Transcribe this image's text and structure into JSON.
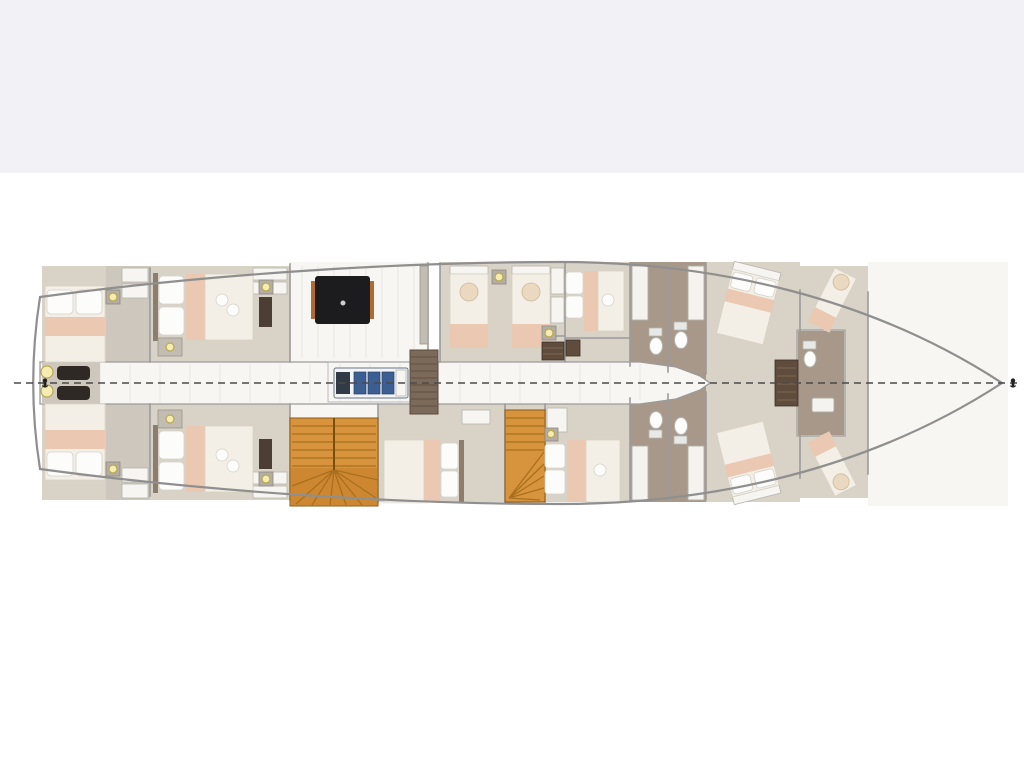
{
  "meta": {
    "title": "Yacht lower deck floor plan",
    "view": "top-down deck plan",
    "bow_direction": "right",
    "visible_text": "none"
  },
  "colors": {
    "page_background": "#ffffff",
    "top_band": "#f1f1f6",
    "hull_outline": "#8f8f8f",
    "wall": "#9b9b9b",
    "cabin_floor": "#d9d2c6",
    "bathroom_floor": "#a79889",
    "corridor_floor": "#f7f6f2",
    "bed_duvet": "#f3efe6",
    "bed_pillow": "#fcfcfb",
    "bed_blanket_pink": "#ebc8b1",
    "stair_wood": "#d8943c",
    "stair_wood_dark": "#cd8730",
    "stair_tread_line": "#a96f1f",
    "dining_table_black": "#1c1c1e",
    "dining_table_trim": "#b06a33",
    "engine_blue": "#3c5e92",
    "dark_wood_cabinet": "#5f4c3c",
    "deck_light_glow": "#f5ecb4",
    "centerline": "#4a4a4a"
  },
  "rooms": [
    {
      "id": "aft-port-cabin",
      "name": "Aft double cabin, port side"
    },
    {
      "id": "aft-starboard-cabin",
      "name": "Aft double cabin, starboard side"
    },
    {
      "id": "port-double-cabin",
      "name": "Double cabin, port side"
    },
    {
      "id": "starboard-double-cabin",
      "name": "Double cabin, starboard side"
    },
    {
      "id": "salon",
      "name": "Salon with black dining table"
    },
    {
      "id": "engine-room",
      "name": "Engine room with engine schematic"
    },
    {
      "id": "twin-cabin-port",
      "name": "Twin cabin with two single berths, port side"
    },
    {
      "id": "midship-double-cabin-port",
      "name": "Midship double cabin, port side"
    },
    {
      "id": "midship-double-cabin-starboard-aft",
      "name": "Midship double cabin, starboard aft"
    },
    {
      "id": "midship-double-cabin-starboard-fwd",
      "name": "Midship double cabin, starboard forward"
    },
    {
      "id": "bathrooms-port",
      "name": "Two ensuite bathrooms, port side"
    },
    {
      "id": "bathrooms-starboard",
      "name": "Two ensuite bathrooms, starboard side"
    },
    {
      "id": "forward-diagonal-cabin-port",
      "name": "Forward angled double cabin, port side"
    },
    {
      "id": "forward-diagonal-cabin-starboard",
      "name": "Forward angled double cabin, starboard side"
    },
    {
      "id": "bow-cabin",
      "name": "Bow cabin with two angled berths and central ensuite"
    },
    {
      "id": "bow-deck",
      "name": "Bow deck"
    },
    {
      "id": "corridor",
      "name": "Central corridor"
    },
    {
      "id": "stern-platform",
      "name": "Stern platform with winches and deck lights"
    },
    {
      "id": "stairs-main",
      "name": "Main wooden staircase"
    },
    {
      "id": "stairs-spiral",
      "name": "Spiral wooden staircase"
    },
    {
      "id": "companionway",
      "name": "Companionway steps beside engine room"
    }
  ],
  "inventory": {
    "double_beds": 9,
    "single_berths": 4,
    "toilets": 5,
    "staircases": 3,
    "dining_tables": 1,
    "engines": 1,
    "stern_deck_lights": 2,
    "wall_lights": 9,
    "centerline_markers": 2
  }
}
